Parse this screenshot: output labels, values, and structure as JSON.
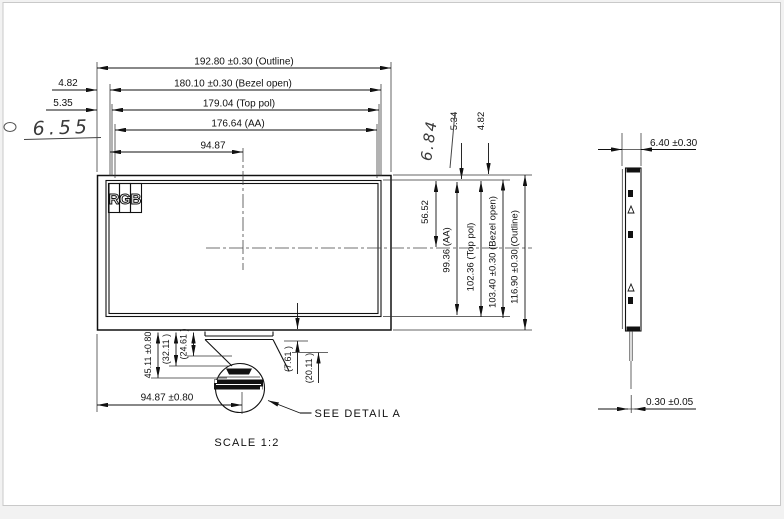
{
  "page": {
    "scale_note": "SCALE 1:2",
    "see_detail": "SEE DETAIL A"
  },
  "colors": {
    "line": "#111111",
    "handwriting": "#3a3a3a"
  },
  "rgb": {
    "r": "R",
    "g": "G",
    "b": "B"
  },
  "front": {
    "width_outline": "192.80  ±0.30  (Outline)",
    "width_bezel": "180.10  ±0.30  (Bezel open)",
    "width_toppol": "179.04  (Top pol)",
    "width_aa": "176.64  (AA)",
    "width_half": "94.87",
    "left_offset_bezel": "4.82",
    "left_offset_toppol": "5.35",
    "left_note": "6.55",
    "top_offset_toppol": "5.34",
    "top_offset_bezel": "4.82",
    "right_note": "6.84",
    "height_half": "56.52",
    "height_aa": "99.36 (AA)",
    "height_toppol": "102.36  (Top pol)",
    "height_bezel": "103.40  ±0.30  (Bezel open)",
    "height_outline": "116.90  ±0.30  (Outline)",
    "tail_length": "45.11 ±0.80",
    "tail_fold_1": "(32.11 )",
    "tail_fold_2": "(24.61 )",
    "tail_right_1": "(7.61 )",
    "tail_right_2": "(20.11 )",
    "connector_center": "94.87  ±0.80"
  },
  "side": {
    "thickness": "6.40  ±0.30",
    "fpc": "0.30  ±0.05"
  }
}
